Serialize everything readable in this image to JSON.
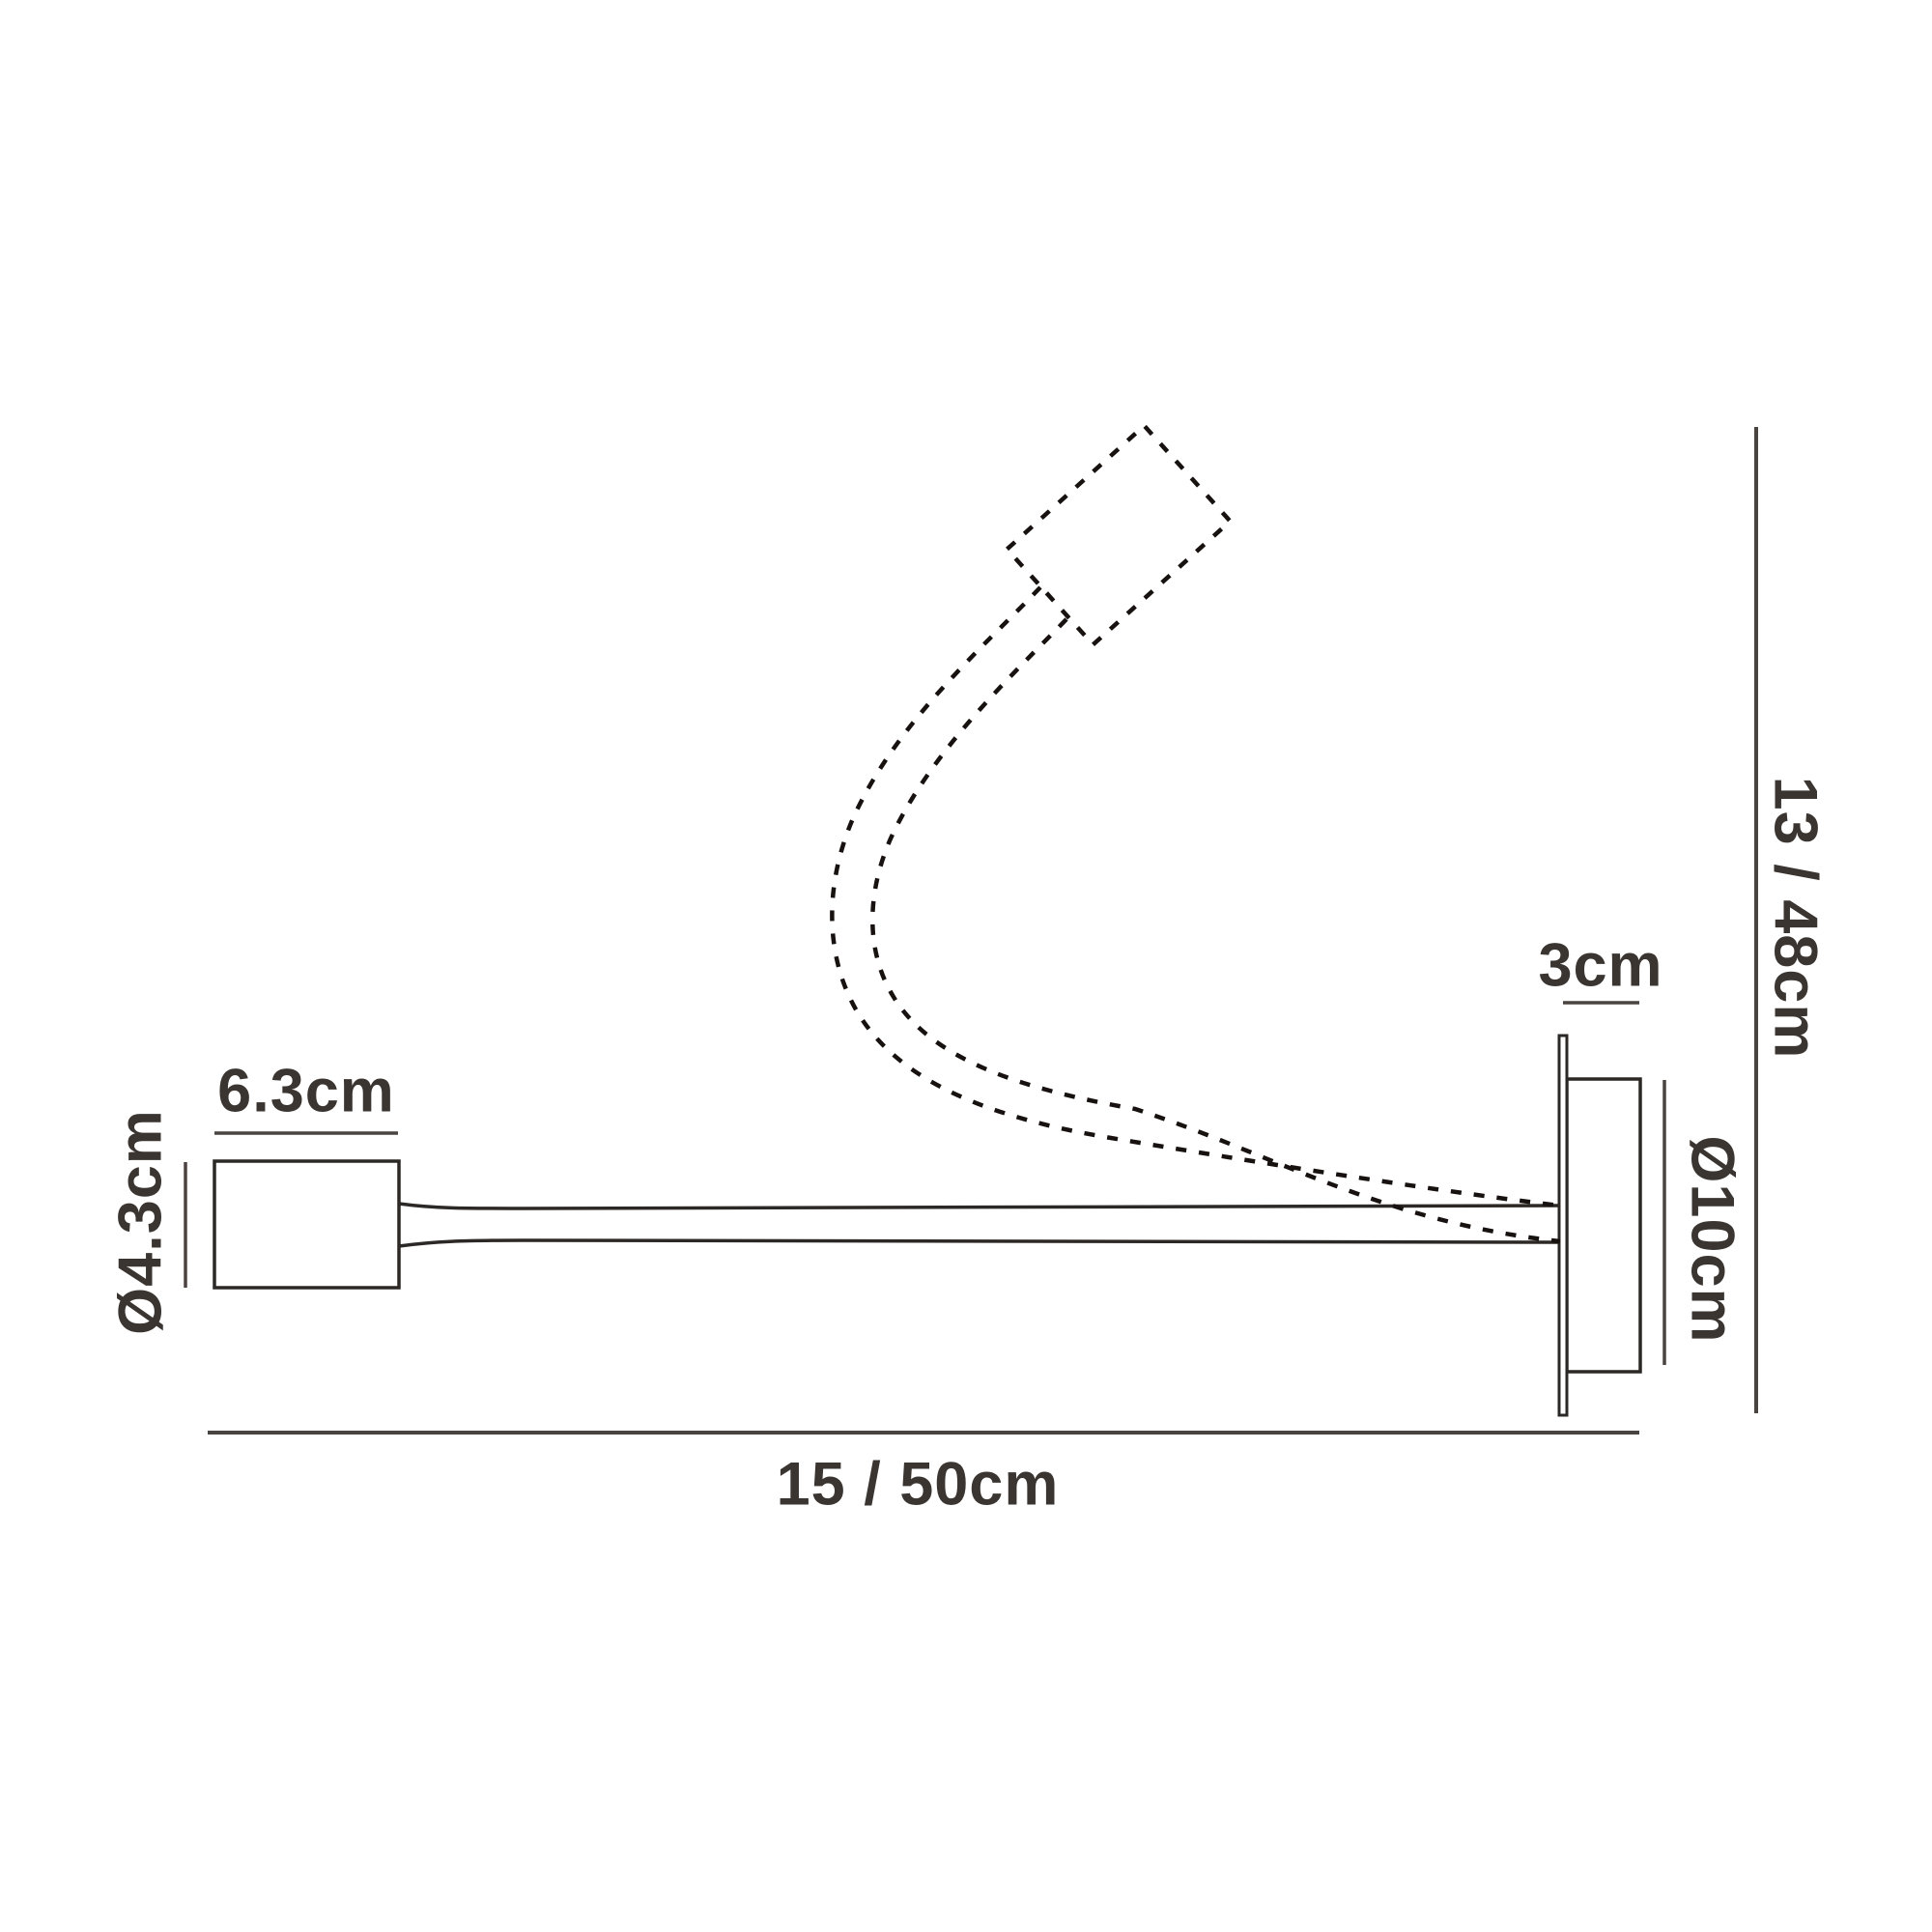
{
  "diagram": {
    "kind": "technical-dimension-drawing",
    "subject": "flexible-arm wall spotlight, side view with raised-arm position shown dotted",
    "colors": {
      "background": "#ffffff",
      "solid_line": "#2c2825",
      "dashed_line": "#17120f",
      "dimension_line": "#4a4440",
      "text": "#3a3531"
    },
    "labels": {
      "head_width": "6.3cm",
      "head_diameter": "Ø4.3cm",
      "mount_depth": "3cm",
      "backplate_diameter": "Ø10cm",
      "height_range": "13 / 48cm",
      "width_range": "15 / 50cm"
    }
  }
}
